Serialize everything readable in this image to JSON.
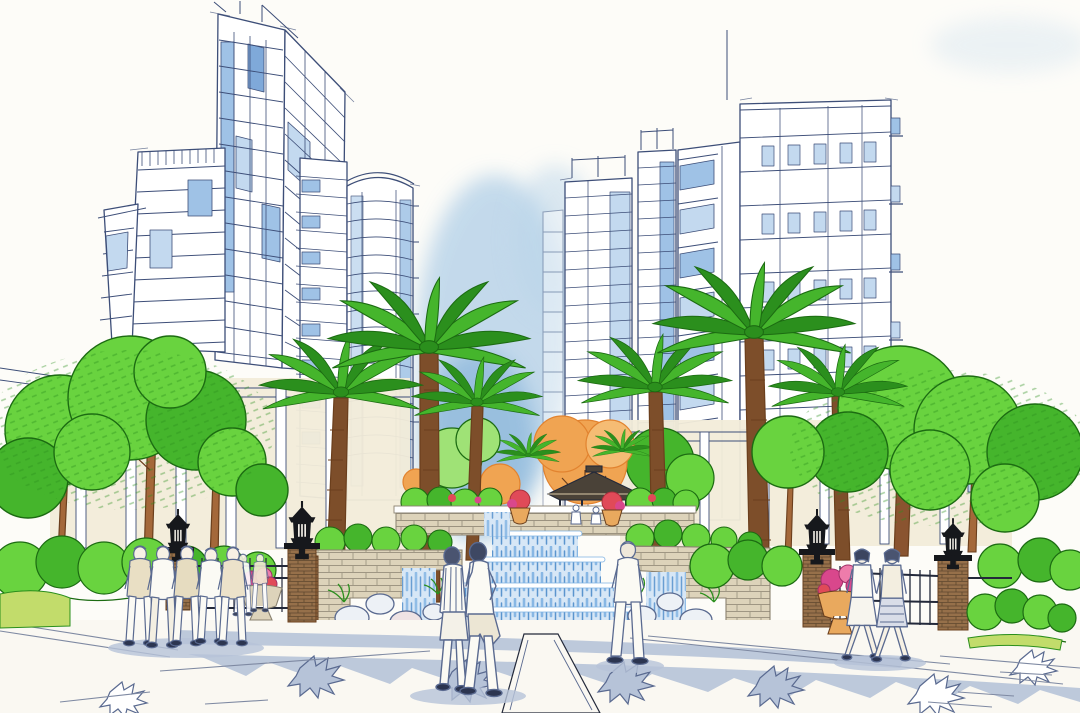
{
  "scene": {
    "type": "hand-drawn architectural perspective rendering (marker and watercolor)",
    "caption": "Marker-and-watercolor rendering of a residential community entry plaza: a terraced waterfall cascades down stone planter walls into a blue reflecting pool on the central axis, flanked by palm trees and bright green shade trees, black ornamental lanterns on stone piers, metal fences, urns of magenta flowers, an autumn-orange tree and a small gazebo on the upper terrace, with sketched high-rise apartment towers rising on both sides and pedestrians strolling the paved foreground.",
    "elements": [
      "left high-rise cluster with glass curtain wall and cylindrical tower",
      "right stepped high-rise cluster with balconies",
      "central watercolor sky wash",
      "palm tree allee",
      "deciduous shade trees",
      "autumn orange tree",
      "gazebo pavilion",
      "four-tier waterfall cascade",
      "reflecting pool with boulders",
      "stone retaining walls and planters",
      "lantern lamps on stone piers",
      "metal fences and entry gate",
      "flower urns",
      "shrub and hedge beds",
      "paved plaza with palm-frond shadows",
      "group of five pedestrians at left",
      "couple in the center foreground",
      "man viewing the waterfall",
      "two women walking at right"
    ]
  },
  "colors": {
    "paper": "#fdfcf8",
    "ink": "#3d4e78",
    "ink_dark": "#23293a",
    "person_ink": "#5a6a90",
    "glass_light": "#c3d9ef",
    "glass_mid": "#9fc2e6",
    "glass_deep": "#7fa9d9",
    "wash_sky": "#b9d4e9",
    "wash_sky_deep": "#8fb9dc",
    "foliage_bright": "#69d33f",
    "foliage_mid": "#45b52c",
    "foliage_dark": "#2b8f1d",
    "foliage_light": "#9fe276",
    "foliage_ink": "#1c6b12",
    "grass_yellow": "#c2dc6b",
    "orange_leaf": "#f0a452",
    "orange_deep": "#e2832f",
    "trunk": "#a4683a",
    "trunk_dark": "#6b3f1d",
    "palm_trunk": "#7d4e2a",
    "stone_tan": "#ddd3ba",
    "stone_joint": "#8a8270",
    "stone_pier": "#96704a",
    "wall_cream": "#f2ecd9",
    "water_light": "#d7e7f6",
    "water_mid": "#7fb2e2",
    "water_deep": "#4d8cc9",
    "pool": "#5e9bd4",
    "plaza_shade": "#b6c3d8",
    "pavement": "#faf8f2",
    "flower_red": "#e04a58",
    "flower_magenta": "#d9478c",
    "urn": "#e9a95e",
    "lantern": "#16181c",
    "roof_dark": "#4a4238",
    "rock": "#edf1f6",
    "rock_pink": "#efe3e4",
    "shoe": "#2c3550"
  }
}
